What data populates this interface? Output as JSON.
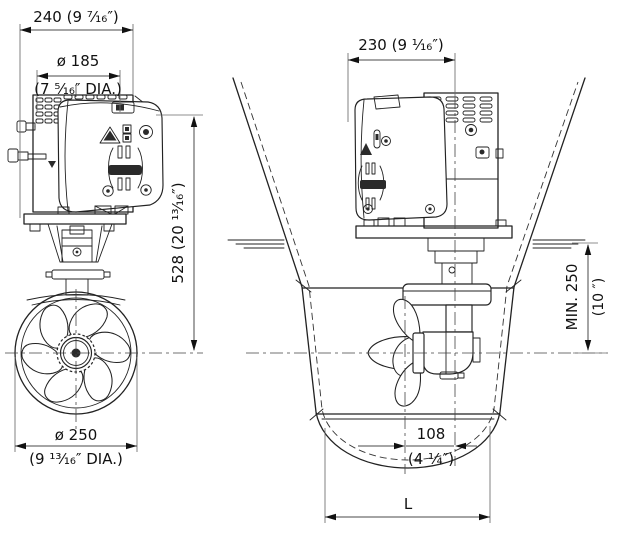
{
  "drawing": {
    "description": "Bow thruster dimensional drawing: front view and hull-section side view",
    "colors": {
      "background": "#ffffff",
      "line": "#222222",
      "dimension": "#4a4a4a",
      "text": "#111111"
    }
  },
  "front_view": {
    "dim_motor_width": "240 (9 ⁷⁄₁₆″)",
    "dim_flange_dia_mm": "ø 185",
    "dim_flange_dia_in": "(7 ⁵⁄₁₆″ DIA.)",
    "dim_overall_height": "528 (20 ¹³⁄₁₆″)",
    "dim_propeller_dia_mm": "ø 250",
    "dim_propeller_dia_in": "(9 ¹³⁄₁₆″ DIA.)"
  },
  "side_view": {
    "dim_motor_depth": "230 (9 ¹⁄₁₆″)",
    "dim_min_submersion_mm": "MIN. 250",
    "dim_min_submersion_in": "(10 ″)",
    "dim_prop_offset_mm": "108",
    "dim_prop_offset_in": "(4 ¹⁄₄″)",
    "dim_tunnel_length": "L"
  }
}
